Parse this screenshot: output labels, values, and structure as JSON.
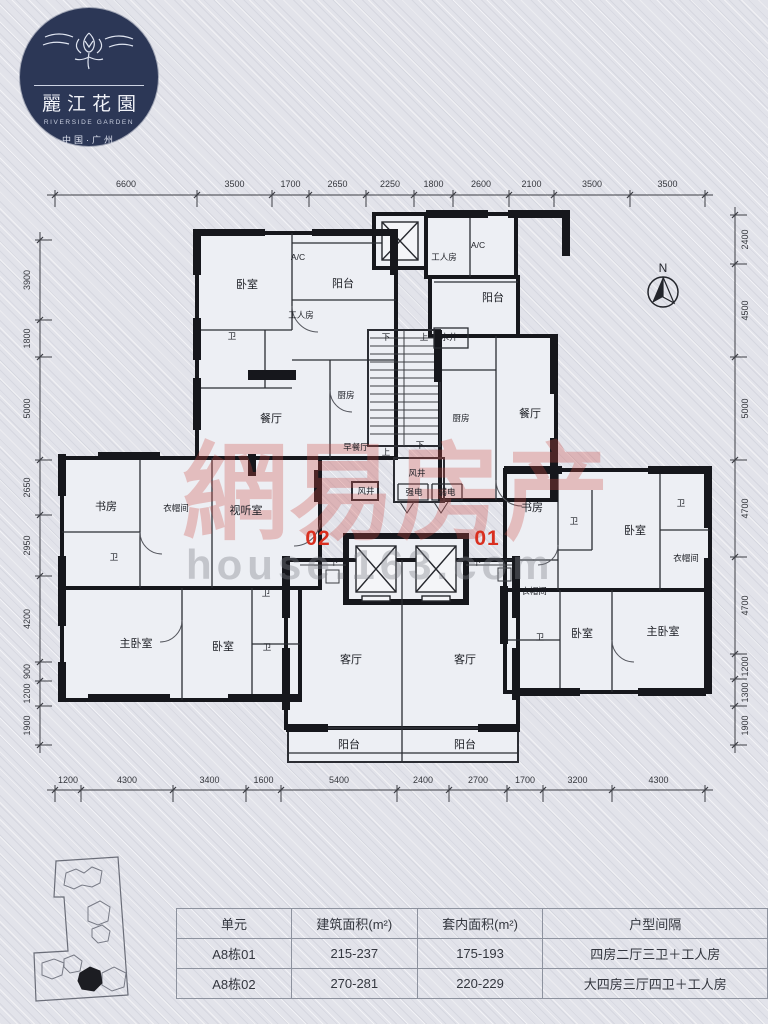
{
  "logo": {
    "title_cn": "麗江花園",
    "title_en": "RIVERSIDE GARDEN",
    "subtitle": "中国·广州"
  },
  "compass": {
    "label": "N"
  },
  "watermark": {
    "text_cn": "網易房产",
    "text_en": "house.163.com"
  },
  "unit_labels": [
    {
      "text": "02",
      "x": 318,
      "y": 539
    },
    {
      "text": "01",
      "x": 487,
      "y": 539
    }
  ],
  "floor_plan": {
    "rooms": [
      {
        "label": "卧室",
        "x": 247,
        "y": 284
      },
      {
        "label": "A/C",
        "x": 298,
        "y": 257,
        "s": 1
      },
      {
        "label": "阳台",
        "x": 343,
        "y": 283
      },
      {
        "label": "工人房",
        "x": 301,
        "y": 315,
        "s": 1
      },
      {
        "label": "卫",
        "x": 232,
        "y": 336,
        "s": 1
      },
      {
        "label": "厨房",
        "x": 346,
        "y": 395,
        "s": 1
      },
      {
        "label": "餐厅",
        "x": 271,
        "y": 418
      },
      {
        "label": "早餐厅",
        "x": 356,
        "y": 447,
        "s": 1
      },
      {
        "label": "书房",
        "x": 106,
        "y": 506
      },
      {
        "label": "衣帽间",
        "x": 176,
        "y": 508,
        "s": 1
      },
      {
        "label": "视听室",
        "x": 246,
        "y": 510
      },
      {
        "label": "卫",
        "x": 114,
        "y": 557,
        "s": 1
      },
      {
        "label": "主卧室",
        "x": 136,
        "y": 643
      },
      {
        "label": "卧室",
        "x": 223,
        "y": 646
      },
      {
        "label": "卫",
        "x": 266,
        "y": 593,
        "s": 1
      },
      {
        "label": "卫",
        "x": 267,
        "y": 647,
        "s": 1
      },
      {
        "label": "客厅",
        "x": 351,
        "y": 659
      },
      {
        "label": "阳台",
        "x": 349,
        "y": 744
      },
      {
        "label": "下",
        "x": 386,
        "y": 337,
        "s": 1
      },
      {
        "label": "上",
        "x": 424,
        "y": 337,
        "s": 1
      },
      {
        "label": "水井",
        "x": 449,
        "y": 337,
        "s": 1
      },
      {
        "label": "上",
        "x": 386,
        "y": 452,
        "s": 1
      },
      {
        "label": "下",
        "x": 420,
        "y": 445,
        "s": 1
      },
      {
        "label": "风井",
        "x": 417,
        "y": 473,
        "s": 1
      },
      {
        "label": "风井",
        "x": 366,
        "y": 491,
        "s": 1
      },
      {
        "label": "强电",
        "x": 414,
        "y": 492,
        "s": 1
      },
      {
        "label": "弱电",
        "x": 447,
        "y": 492,
        "s": 1
      },
      {
        "label": "下",
        "x": 334,
        "y": 562,
        "s": 1
      },
      {
        "label": "下",
        "x": 477,
        "y": 562,
        "s": 1
      },
      {
        "label": "工人房",
        "x": 444,
        "y": 257,
        "s": 1
      },
      {
        "label": "A/C",
        "x": 478,
        "y": 245,
        "s": 1
      },
      {
        "label": "阳台",
        "x": 493,
        "y": 297
      },
      {
        "label": "厨房",
        "x": 461,
        "y": 418,
        "s": 1
      },
      {
        "label": "餐厅",
        "x": 530,
        "y": 413
      },
      {
        "label": "书房",
        "x": 532,
        "y": 507
      },
      {
        "label": "卫",
        "x": 574,
        "y": 521,
        "s": 1
      },
      {
        "label": "卧室",
        "x": 635,
        "y": 530
      },
      {
        "label": "卫",
        "x": 681,
        "y": 503,
        "s": 1
      },
      {
        "label": "衣帽间",
        "x": 686,
        "y": 558,
        "s": 1
      },
      {
        "label": "衣帽间",
        "x": 534,
        "y": 591,
        "s": 1
      },
      {
        "label": "卫",
        "x": 540,
        "y": 637,
        "s": 1
      },
      {
        "label": "卧室",
        "x": 582,
        "y": 633
      },
      {
        "label": "主卧室",
        "x": 663,
        "y": 631
      },
      {
        "label": "客厅",
        "x": 465,
        "y": 659
      },
      {
        "label": "阳台",
        "x": 465,
        "y": 744
      }
    ]
  },
  "dimensions": {
    "top": [
      {
        "label": "6600",
        "a": 55,
        "b": 197
      },
      {
        "label": "3500",
        "a": 197,
        "b": 272
      },
      {
        "label": "1700",
        "a": 272,
        "b": 309
      },
      {
        "label": "2650",
        "a": 309,
        "b": 366
      },
      {
        "label": "2250",
        "a": 366,
        "b": 414
      },
      {
        "label": "1800",
        "a": 414,
        "b": 453
      },
      {
        "label": "2600",
        "a": 453,
        "b": 509
      },
      {
        "label": "2100",
        "a": 509,
        "b": 554
      },
      {
        "label": "3500",
        "a": 554,
        "b": 630
      },
      {
        "label": "3500",
        "a": 630,
        "b": 705
      }
    ],
    "bottom": [
      {
        "label": "1200",
        "a": 55,
        "b": 81
      },
      {
        "label": "4300",
        "a": 81,
        "b": 173
      },
      {
        "label": "3400",
        "a": 173,
        "b": 246
      },
      {
        "label": "1600",
        "a": 246,
        "b": 281
      },
      {
        "label": "5400",
        "a": 281,
        "b": 397
      },
      {
        "label": "2400",
        "a": 397,
        "b": 449
      },
      {
        "label": "2700",
        "a": 449,
        "b": 507
      },
      {
        "label": "1700",
        "a": 507,
        "b": 543
      },
      {
        "label": "3200",
        "a": 543,
        "b": 612
      },
      {
        "label": "4300",
        "a": 612,
        "b": 705
      }
    ],
    "left": [
      {
        "label": "3900",
        "a": 240,
        "b": 320
      },
      {
        "label": "1800",
        "a": 320,
        "b": 357
      },
      {
        "label": "5000",
        "a": 357,
        "b": 460
      },
      {
        "label": "2650",
        "a": 460,
        "b": 515
      },
      {
        "label": "2950",
        "a": 515,
        "b": 576
      },
      {
        "label": "4200",
        "a": 576,
        "b": 662
      },
      {
        "label": "900",
        "a": 662,
        "b": 681
      },
      {
        "label": "1200",
        "a": 681,
        "b": 706
      },
      {
        "label": "1900",
        "a": 706,
        "b": 745
      }
    ],
    "right": [
      {
        "label": "2400",
        "a": 215,
        "b": 264
      },
      {
        "label": "4500",
        "a": 264,
        "b": 357
      },
      {
        "label": "5000",
        "a": 357,
        "b": 460
      },
      {
        "label": "4700",
        "a": 460,
        "b": 557
      },
      {
        "label": "4700",
        "a": 557,
        "b": 654
      },
      {
        "label": "1200",
        "a": 654,
        "b": 679
      },
      {
        "label": "1300",
        "a": 679,
        "b": 706
      },
      {
        "label": "1900",
        "a": 706,
        "b": 745
      }
    ]
  },
  "table": {
    "headers": [
      "单元",
      "建筑面积(m²)",
      "套内面积(m²)",
      "户型间隔"
    ],
    "rows": [
      [
        "A8栋01",
        "215-237",
        "175-193",
        "四房二厅三卫＋工人房"
      ],
      [
        "A8栋02",
        "270-281",
        "220-229",
        "大四房三厅四卫＋工人房"
      ]
    ]
  },
  "colors": {
    "paper": "#e2e3ea",
    "wall": "#16171c",
    "accent_red": "#d92f1f",
    "watermark_pink": "rgba(205,73,66,0.30)",
    "logo_navy": "#2c3756"
  }
}
